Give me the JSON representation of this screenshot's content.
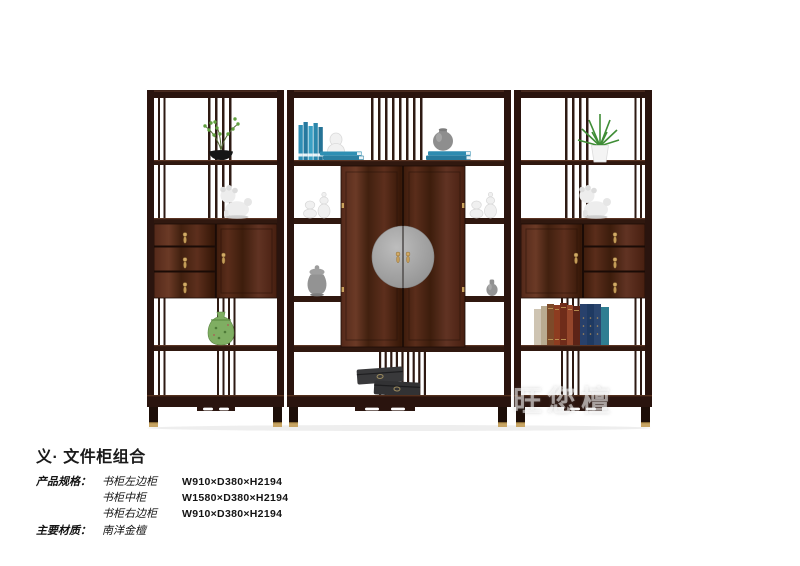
{
  "product": {
    "title": "义· 文件柜组合",
    "spec_label": "产品规格：",
    "specs": [
      {
        "name": "书柜左边柜",
        "dims": "W910×D380×H2194"
      },
      {
        "name": "书柜中柜",
        "dims": "W1580×D380×H2194"
      },
      {
        "name": "书柜右边柜",
        "dims": "W910×D380×H2194"
      }
    ],
    "material_label": "主要材质：",
    "material_value": "南洋金檀"
  },
  "watermark": {
    "text": "旺您檀"
  },
  "image": {
    "description": "三件套深色南洋金檀文件柜组合：左边柜、中柜（双门圆铜面板）、右边柜",
    "decor_items": [
      "black-bowl-bonsai-plant",
      "white-foo-dog-statue-left",
      "green-porcelain-jar",
      "teal-books-standing",
      "white-gourd-vase",
      "teal-books-stacked",
      "gray-round-jar",
      "white-glass-jars",
      "gray-lidded-jar",
      "small-gray-vase",
      "black-storage-boxes",
      "green-plant-white-pot",
      "white-foo-dog-statue-right",
      "book-row-spines"
    ],
    "colors": {
      "wood_dark": "#2a140e",
      "wood_face": "#4b2416",
      "brass": "#c8a564",
      "door_plate_gray": "#9e9e9e",
      "book_teal": "#2f8fb6",
      "vase_green": "#7fae62",
      "statue_white": "#ededed",
      "box_black": "#39393b"
    }
  }
}
